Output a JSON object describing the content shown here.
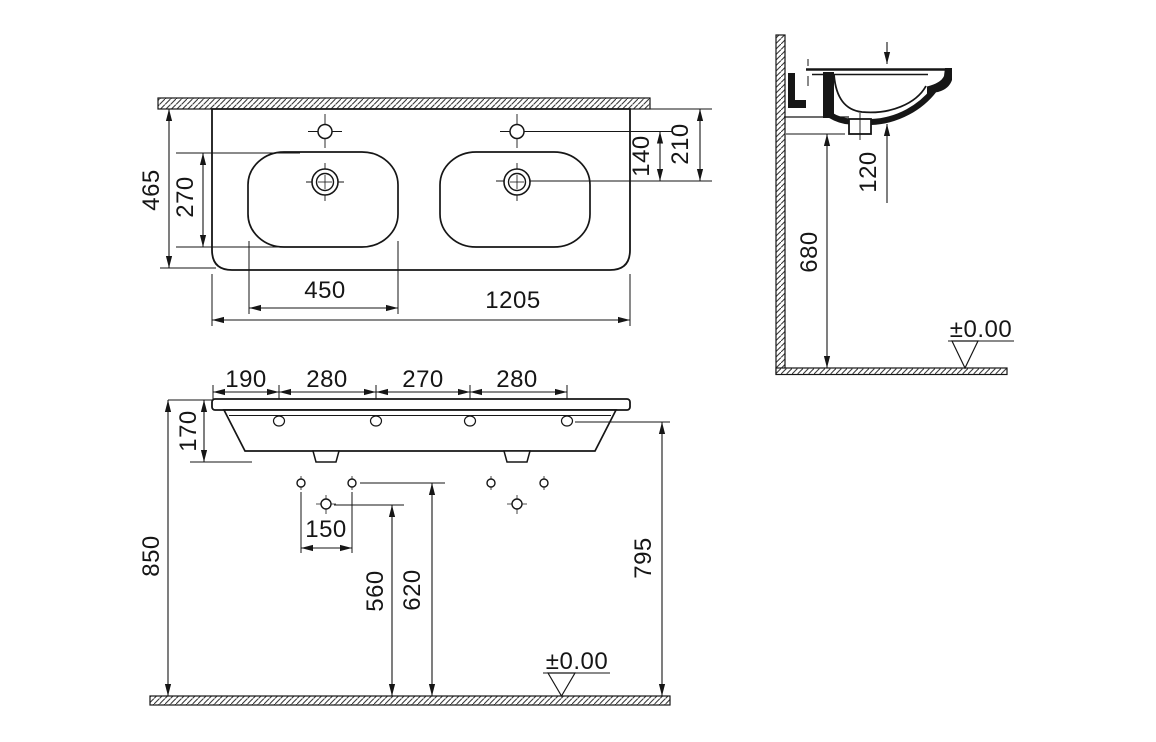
{
  "drawing": {
    "product": "double-washbasin-technical-drawing",
    "plan": {
      "depth_overall": "465",
      "bowl_depth": "270",
      "bowl_width": "450",
      "width_overall": "1205",
      "tap_to_drain": "140",
      "front_edge_to_drain": "210"
    },
    "side": {
      "bowl_inner_depth": "120",
      "underside_height": "680",
      "floor_datum": "±0.00"
    },
    "front": {
      "edge_to_fixing1": "190",
      "fixing_span1": "280",
      "fixing_span2": "270",
      "fixing_span3": "280",
      "basin_body_height": "170",
      "rim_height_total": "850",
      "wall_hole_spacing": "150",
      "lower_hole_height": "560",
      "upper_hole_height": "620",
      "underside_clearance": "795",
      "floor_datum": "±0.00"
    }
  }
}
